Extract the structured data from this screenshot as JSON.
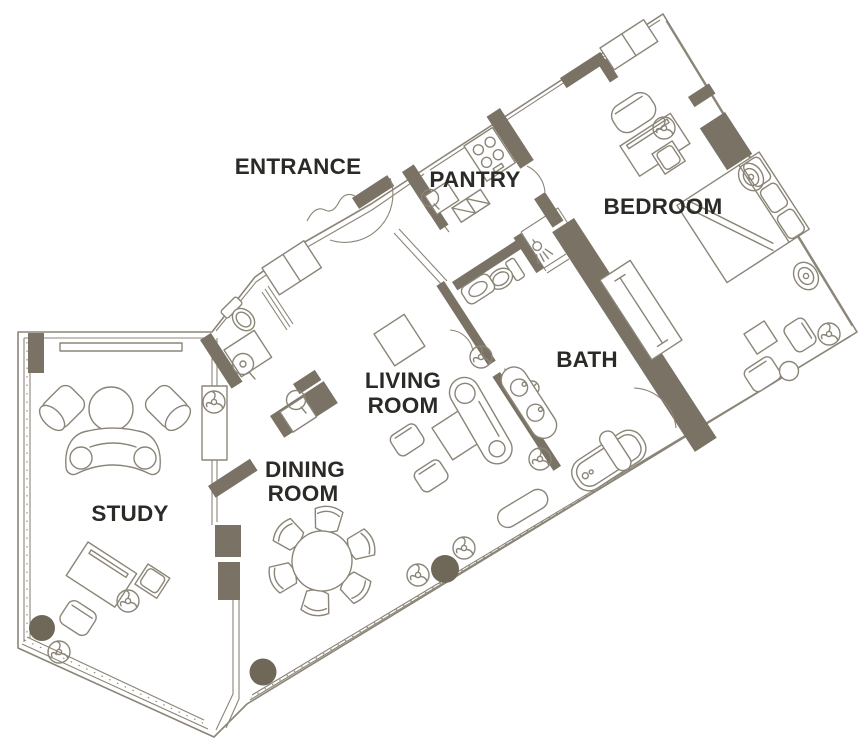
{
  "figure": {
    "type": "floor-plan",
    "description": "Suite floor plan with labeled rooms"
  },
  "colors": {
    "wall": "#7a7265",
    "outline": "#8b8578",
    "label": "#2b2a27",
    "column": "#6f6758",
    "background": "#ffffff"
  },
  "rooms": {
    "entrance": {
      "label": "ENTRANCE"
    },
    "pantry": {
      "label": "PANTRY"
    },
    "bedroom": {
      "label": "BEDROOM"
    },
    "living_room": {
      "line1": "LIVING",
      "line2": "ROOM"
    },
    "bath": {
      "label": "BATH"
    },
    "dining_room": {
      "line1": "DINING",
      "line2": "ROOM"
    },
    "study": {
      "label": "STUDY"
    }
  },
  "icons": {
    "fan-coil-icon": "circle with three curved blades",
    "table-lamp-icon": "concentric ovals",
    "shower-head-icon": "circle with spray lines",
    "column-marker": "solid filled circle"
  },
  "furniture": {
    "study": [
      "round-table",
      "barrel-chair",
      "barrel-chair",
      "curved-sofa",
      "desk",
      "desk-chair",
      "armchair",
      "tv-cabinet",
      "window-sill"
    ],
    "dining_room": [
      "round-dining-table",
      "dining-chair x6",
      "wet-bar-counter"
    ],
    "living_room": [
      "side-table",
      "armchair x2",
      "square-ottoman",
      "chaise-longue",
      "window-bench",
      "plant"
    ],
    "bath": [
      "bathtub",
      "double-vanity",
      "toilet",
      "sink",
      "shower",
      "linen-closet"
    ],
    "bedroom": [
      "bed",
      "pillows x3",
      "table-lamp x2",
      "desk",
      "desk-chair",
      "stool",
      "wardrobe",
      "armchair x2",
      "side-table",
      "round-table",
      "window-bench"
    ],
    "pantry": [
      "stove",
      "sink-counter",
      "dishwasher"
    ],
    "entrance": [
      "closet",
      "door-swing"
    ],
    "powder_room": [
      "toilet",
      "vanity-sink"
    ]
  }
}
